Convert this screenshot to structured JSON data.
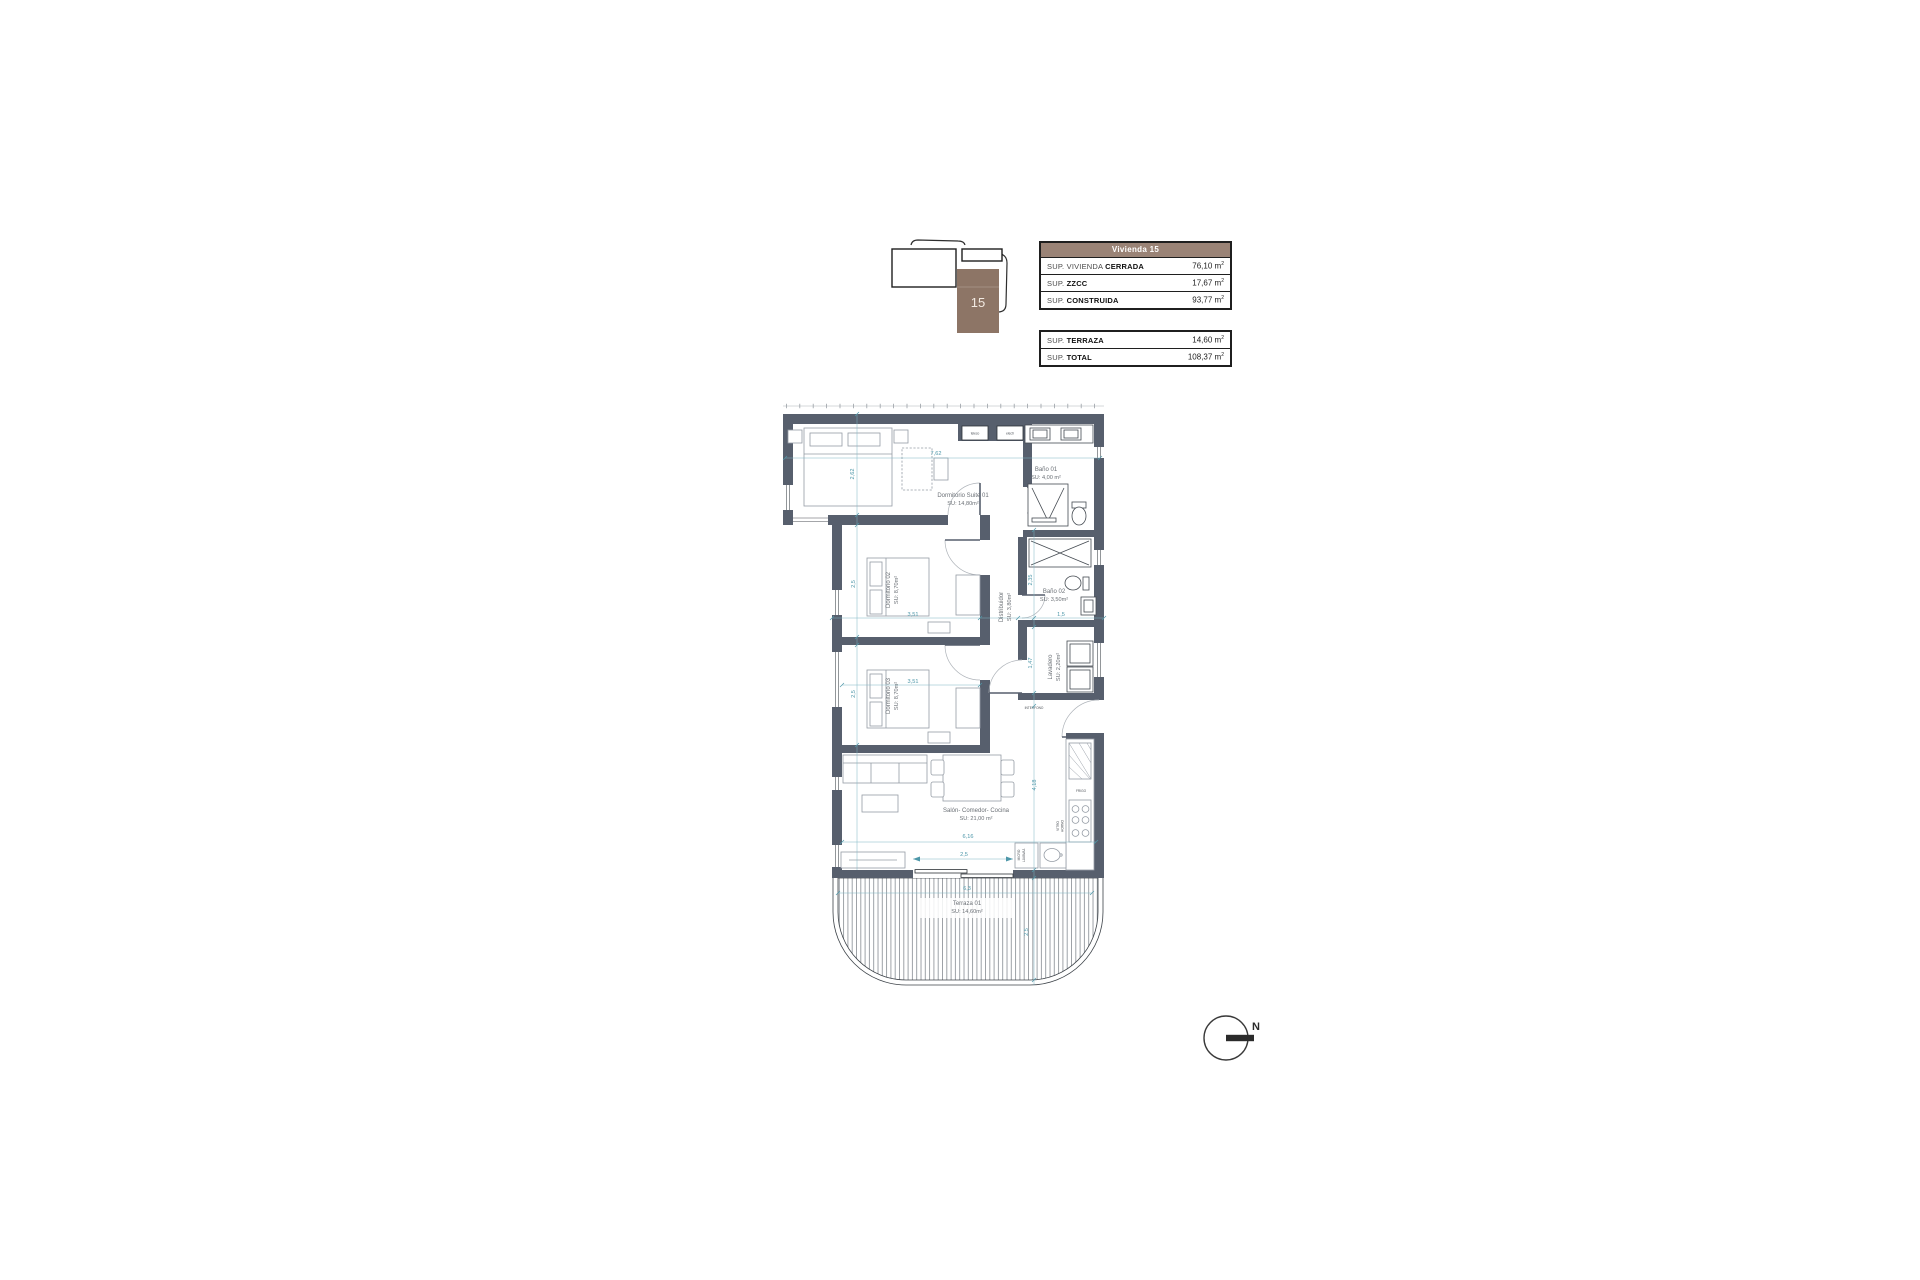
{
  "colors": {
    "wall": "#575f6d",
    "dimension_teal": "#4d97a9",
    "room_label_gray": "#6b7076",
    "table_header_brown": "#9a8376",
    "keyplan_brown": "#8d7566"
  },
  "key_plan": {
    "unit_label": "15"
  },
  "summary_tables": {
    "main": {
      "header": "Vivienda 15",
      "rows": [
        {
          "label_regular": "SUP. VIVIENDA ",
          "label_bold": "CERRADA",
          "value": "76,10",
          "unit": "m",
          "sup": "2"
        },
        {
          "label_regular": "SUP. ",
          "label_bold": "ZZCC",
          "value": "17,67",
          "unit": "m",
          "sup": "2"
        },
        {
          "label_regular": "SUP. ",
          "label_bold": "CONSTRUIDA",
          "value": "93,77",
          "unit": "m",
          "sup": "2"
        }
      ]
    },
    "secondary": {
      "rows": [
        {
          "label_regular": "SUP. ",
          "label_bold": "TERRAZA",
          "value": "14,60",
          "unit": "m",
          "sup": "2"
        },
        {
          "label_regular": "SUP. ",
          "label_bold": "TOTAL",
          "value": "108,37",
          "unit": "m",
          "sup": "2"
        }
      ]
    }
  },
  "floor_plan": {
    "rooms": {
      "suite": {
        "name": "Dormitorio Suite 01",
        "area": "SU: 14,80m²"
      },
      "bano1": {
        "name": "Baño 01",
        "area": "SU: 4,00 m²"
      },
      "dorm2": {
        "name": "Dormitorio 02",
        "area": "SU: 8,70m²"
      },
      "dorm3": {
        "name": "Dormitorio 03",
        "area": "SU: 8,70m²"
      },
      "distribuidor": {
        "name": "Distribuidor",
        "area": "SU: 3,80m²"
      },
      "bano2": {
        "name": "Baño 02",
        "area": "SU: 3,50m²"
      },
      "lavadero": {
        "name": "Lavadero",
        "area": "SU: 2,20m²"
      },
      "salon": {
        "name": "Salón- Comedor- Cocina",
        "area": "SU: 21,00 m²"
      },
      "terraza": {
        "name": "Terraza 01",
        "area": "SU: 14,60m²"
      }
    },
    "fixtures": {
      "teleco": "teleco",
      "electr": "electr",
      "frigo": "FRIGO",
      "vitro": "VITRO",
      "horno": "HORNO",
      "micro": "MICRO",
      "lavavajillas": "LAVAVAJ.",
      "interfono": "INTERFONO"
    },
    "dims": {
      "suite_width": "7,62",
      "suite_depth": "2,62",
      "dorm2_depth": "2,5",
      "dorm2_width": "3,51",
      "dorm3_depth": "2,5",
      "dorm3_width": "3,51",
      "bano2_depth": "2,35",
      "bano2_width": "1,5",
      "lavadero_depth": "1,47",
      "salon_depth": "4,18",
      "salon_width": "6,16",
      "salon_opening": "2,5",
      "terraza_width": "6,3",
      "terraza_depth": "2,5"
    }
  },
  "north_arrow": {
    "label": "N"
  }
}
